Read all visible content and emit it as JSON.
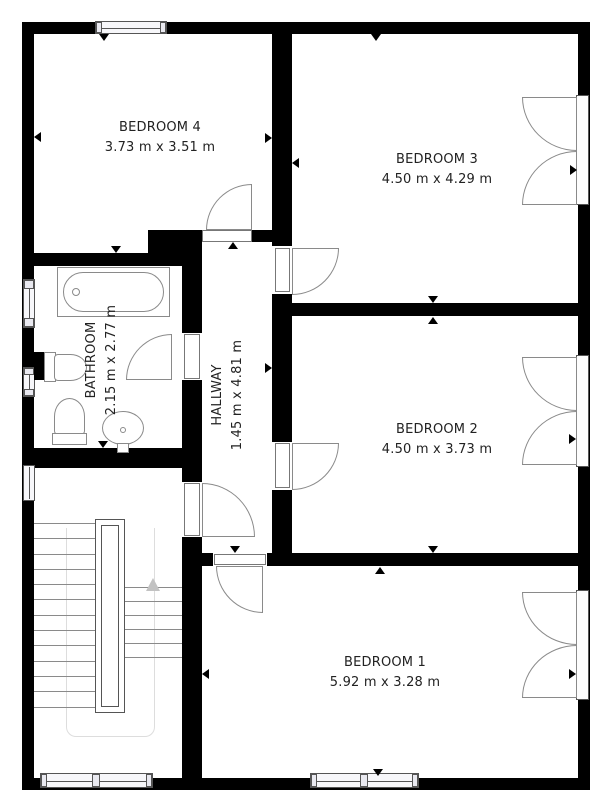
{
  "floorplan": {
    "rooms": {
      "bedroom1": {
        "name": "BEDROOM 1",
        "dims": "5.92 m x 3.28 m"
      },
      "bedroom2": {
        "name": "BEDROOM 2",
        "dims": "4.50 m x 3.73 m"
      },
      "bedroom3": {
        "name": "BEDROOM 3",
        "dims": "4.50 m x 4.29 m"
      },
      "bedroom4": {
        "name": "BEDROOM 4",
        "dims": "3.73 m x 3.51 m"
      },
      "bathroom": {
        "name": "BATHROOM",
        "dims": "2.15 m x 2.77 m"
      },
      "hallway": {
        "name": "HALLWAY",
        "dims": "1.45 m x 4.81 m"
      }
    },
    "colors": {
      "wall": "#000000",
      "background": "#ffffff",
      "fixture_line": "#8a8a8a"
    }
  }
}
